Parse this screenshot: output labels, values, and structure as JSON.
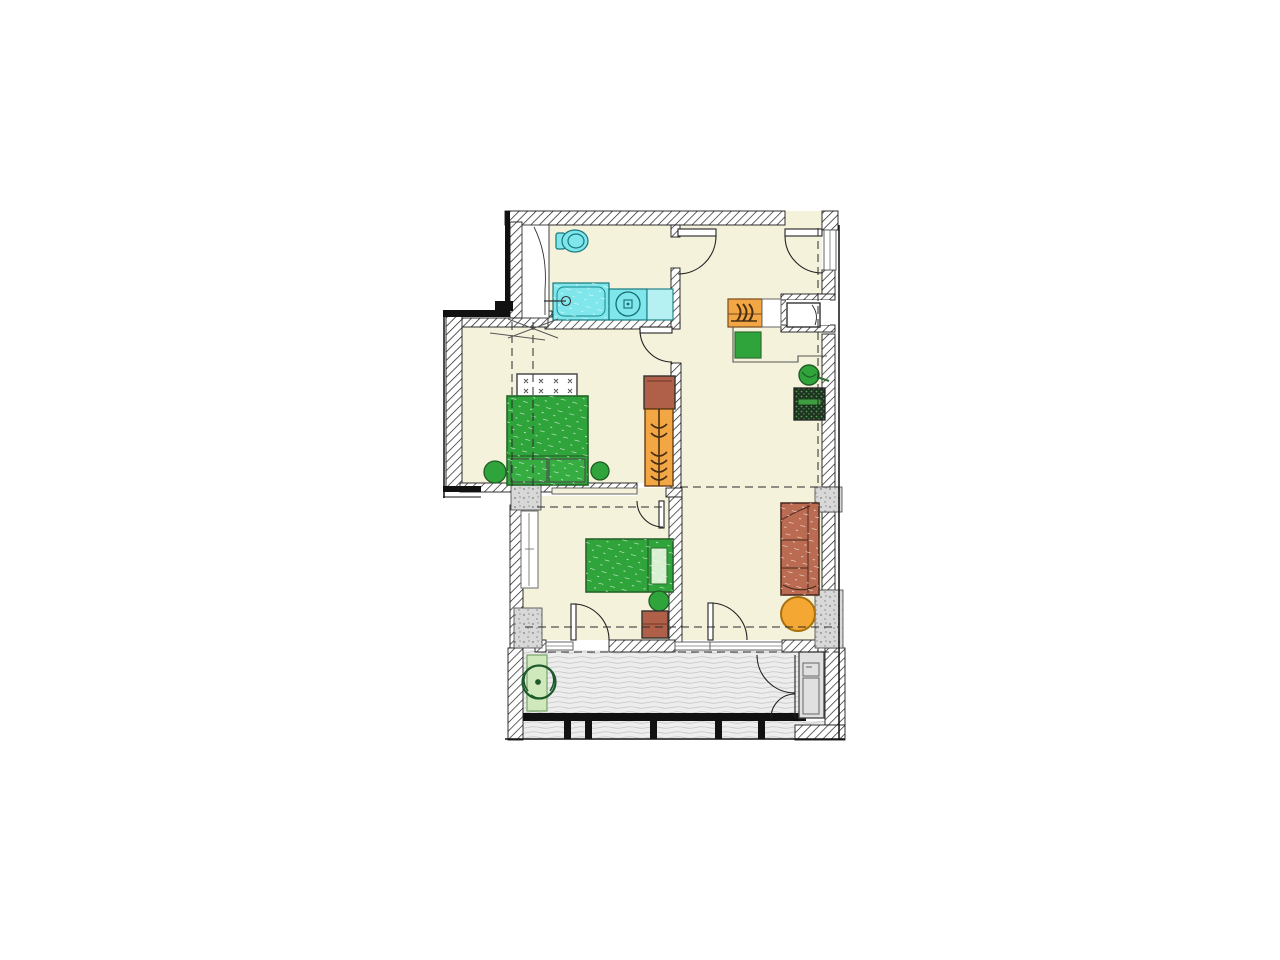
{
  "document": {
    "type_hint": "apartment-floor-plan",
    "rooms": [
      "bathroom",
      "master-bedroom",
      "second-bedroom",
      "living-room-kitchen",
      "balcony"
    ],
    "fixtures": [
      "toilet",
      "bathtub",
      "washing-machine",
      "sink",
      "stove",
      "fridge",
      "kitchen-sink"
    ],
    "furniture": [
      "double-bed",
      "headboard",
      "nightstand",
      "wardrobe",
      "armchair",
      "single-bed",
      "sofa",
      "round-table",
      "plant",
      "planter",
      "balcony-cabinet",
      "appliance"
    ]
  },
  "colors": {
    "floor": "#F5F2DC",
    "white": "#FFFFFF",
    "outline": "#111111",
    "fixture_cyan": "#7FE6EC",
    "fixture_cyan_light": "#B5F1F3",
    "furniture_green": "#2FA43B",
    "furniture_green_mid": "#35AD41",
    "pillow_green": "#D9F0D2",
    "wood_orange": "#F2A744",
    "sofa_brown": "#BB6B51",
    "chair_brown": "#B05F49",
    "table_amber": "#F5A733",
    "planter_green": "#CFE9BD",
    "cabinet_gray": "#E0E0E0",
    "appliance_bar_green": "#3F9C41"
  }
}
